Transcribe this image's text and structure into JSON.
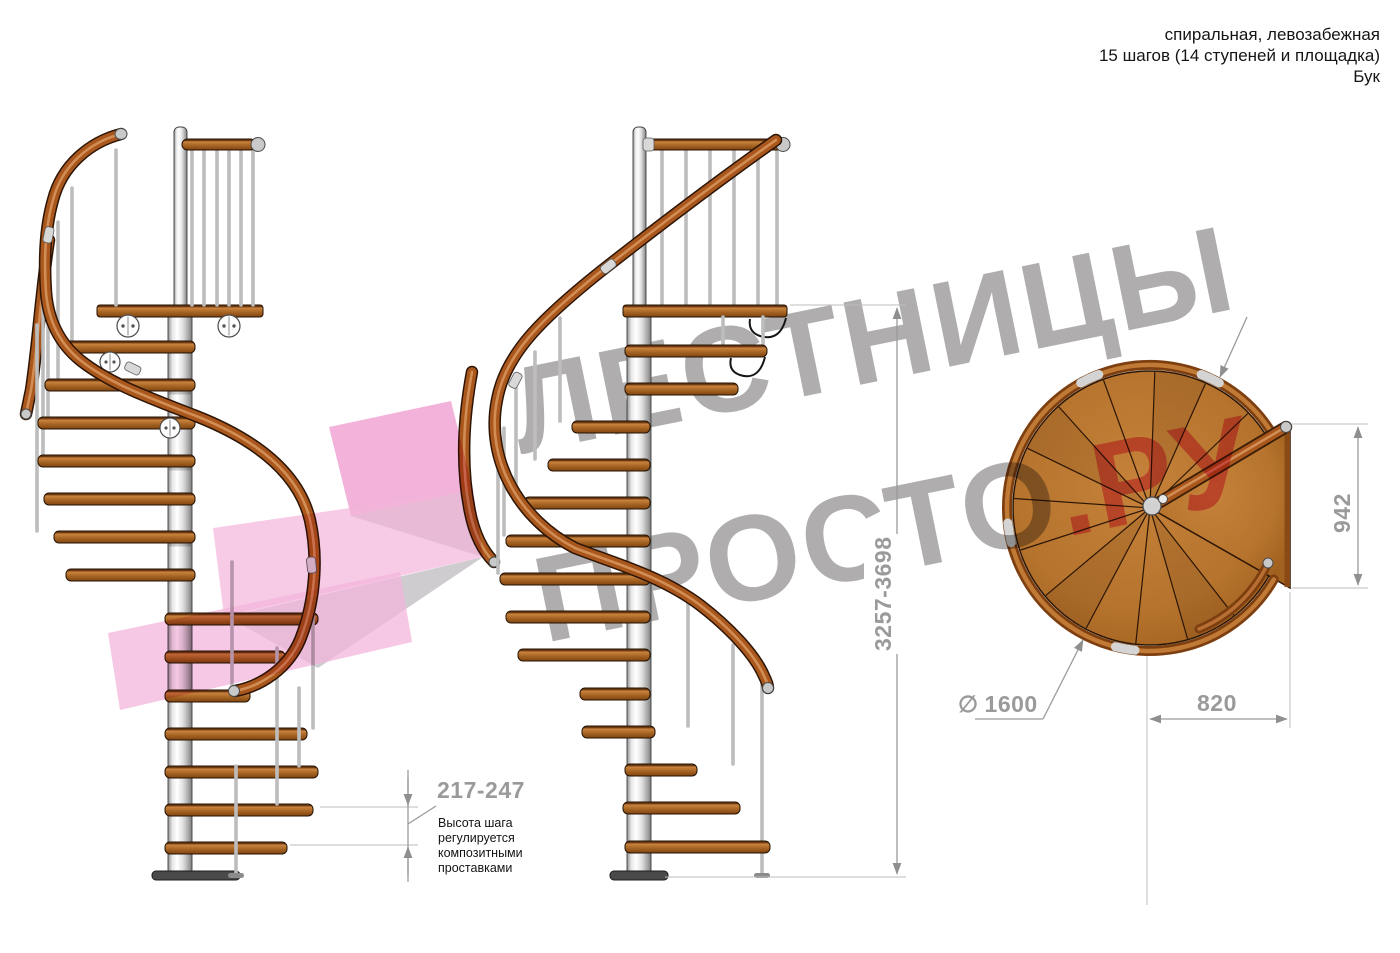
{
  "header": {
    "line1": "спиральная, левозабежная",
    "line2": "15 шагов (14 ступеней и площадка)",
    "line3": "Бук"
  },
  "watermark": {
    "line1": "ЛЕСТНИЦЫ",
    "line2_gray": "ПРОСТО",
    "line2_pink": ".РУ"
  },
  "dimensions": {
    "step_height": {
      "value": "217-247",
      "note_lines": [
        "Высота шага",
        "регулируется",
        "композитными",
        "проставками"
      ]
    },
    "total_height": "3257-3698",
    "landing_side": "942",
    "landing_depth": "820",
    "diameter": {
      "symbol": "∅",
      "value": "1600"
    }
  },
  "colors": {
    "accent_pink": "#f07fae",
    "logo_pink": "#f3b5dc",
    "watermark_gray": "#a8a6a6",
    "wood": "#b5732d",
    "rail_wood": "#a9571c",
    "metal_gray": "#d9d9d9",
    "dimension_gray": "#9a9a9a"
  }
}
